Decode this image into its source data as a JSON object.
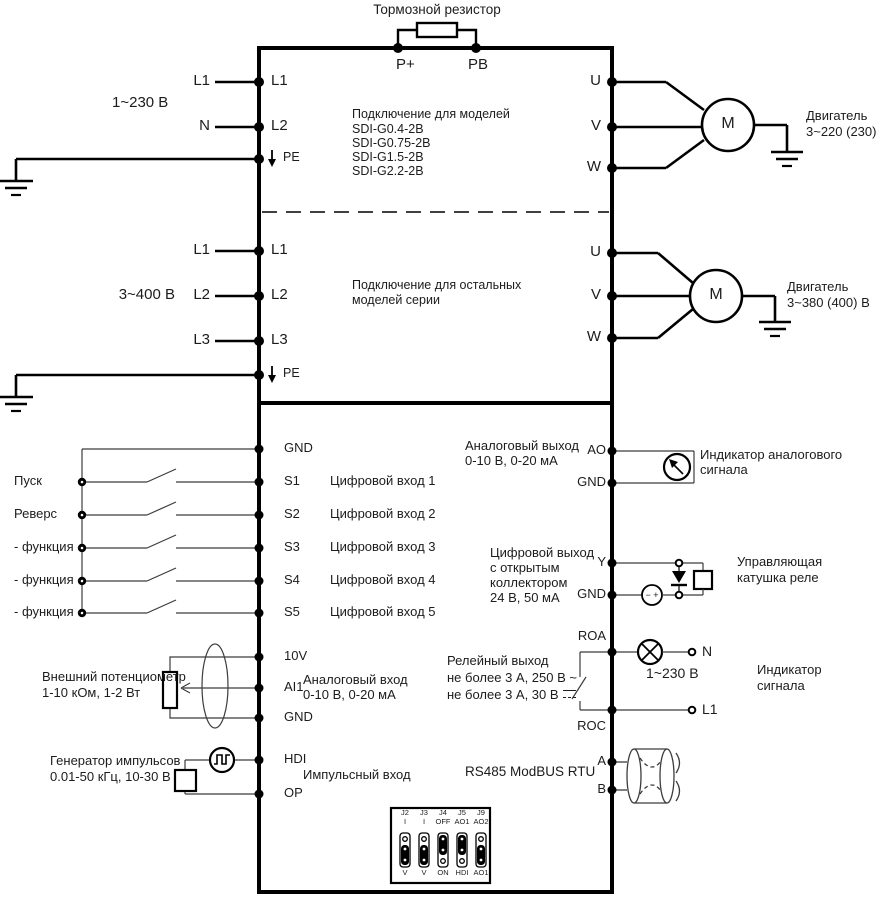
{
  "power": {
    "brake_resistor": "Тормозной резистор",
    "t_p_plus": "P+",
    "t_pb": "PB",
    "s1": {
      "voltage": "1~230 В",
      "wire_l1": "L1",
      "wire_n": "N",
      "t_l1": "L1",
      "t_l2": "L2",
      "t_pe": "PE",
      "note": [
        "Подключение для моделей",
        "SDI-G0.4-2B",
        "SDI-G0.75-2B",
        "SDI-G1.5-2B",
        "SDI-G2.2-2B"
      ],
      "t_u": "U",
      "t_v": "V",
      "t_w": "W",
      "motor": "M",
      "motor_caption": [
        "Двигатель",
        "3~220 (230) В"
      ]
    },
    "s2": {
      "voltage": "3~400 В",
      "wire_l1": "L1",
      "wire_l2": "L2",
      "wire_l3": "L3",
      "t_l1": "L1",
      "t_l2": "L2",
      "t_l3": "L3",
      "t_pe": "PE",
      "note": [
        "Подключение для остальных",
        "моделей серии"
      ],
      "t_u": "U",
      "t_v": "V",
      "t_w": "W",
      "motor": "M",
      "motor_caption": [
        "Двигатель",
        "3~380 (400) В"
      ]
    }
  },
  "control": {
    "inputs": {
      "run": "Пуск",
      "reverse": "Реверс",
      "func": "- функция -",
      "t_gnd": "GND",
      "t": [
        "S1",
        "S2",
        "S3",
        "S4",
        "S5"
      ],
      "labels": [
        "Цифровой вход 1",
        "Цифровой вход 2",
        "Цифровой вход 3",
        "Цифровой вход 4",
        "Цифровой вход 5"
      ]
    },
    "analog_in": {
      "t_10v": "10V",
      "t_ai1": "AI1",
      "t_gnd": "GND",
      "label": [
        "Аналоговый вход",
        "0-10 В, 0-20 мА"
      ],
      "pot": [
        "Внешний потенциометр",
        "1-10 кОм, 1-2 Вт"
      ]
    },
    "pulse": {
      "t_hdi": "HDI",
      "t_op": "OP",
      "label": "Импульсный вход",
      "gen": [
        "Генератор импульсов",
        "0.01-50 кГц, 10-30 В"
      ]
    },
    "analog_out": {
      "t_ao": "AO",
      "t_gnd": "GND",
      "label": [
        "Аналоговый выход",
        "0-10 В, 0-20 мА"
      ],
      "indicator": [
        "Индикатор аналогового",
        "сигнала"
      ]
    },
    "digital_out": {
      "t_y": "Y",
      "t_gnd": "GND",
      "label": [
        "Цифровой выход",
        "с открытым",
        "коллектором",
        "24 В, 50 мА"
      ],
      "coil": [
        "Управляющая",
        "катушка реле"
      ],
      "source": "− +"
    },
    "relay": {
      "t_roa": "ROA",
      "t_roc": "ROC",
      "label": [
        "Релейный выход",
        "не более 3 А, 250 В ~",
        "не более 3 А, 30 В"
      ],
      "voltage": "1~230 В",
      "wire_n": "N",
      "wire_l1": "L1",
      "indicator": [
        "Индикатор",
        "сигнала"
      ]
    },
    "rs485": {
      "label": "RS485 ModBUS RTU",
      "t_a": "A",
      "t_b": "B"
    },
    "jumpers": {
      "names": [
        "J2",
        "J3",
        "J4",
        "J5",
        "J9"
      ],
      "top": [
        "I",
        "I",
        "OFF",
        "AO1",
        "AO2"
      ],
      "bottom": [
        "V",
        "V",
        "ON",
        "HDI",
        "AO1"
      ]
    }
  },
  "colors": {
    "line": "#000000",
    "control_line": "#3c3c3c",
    "background": "#ffffff"
  }
}
